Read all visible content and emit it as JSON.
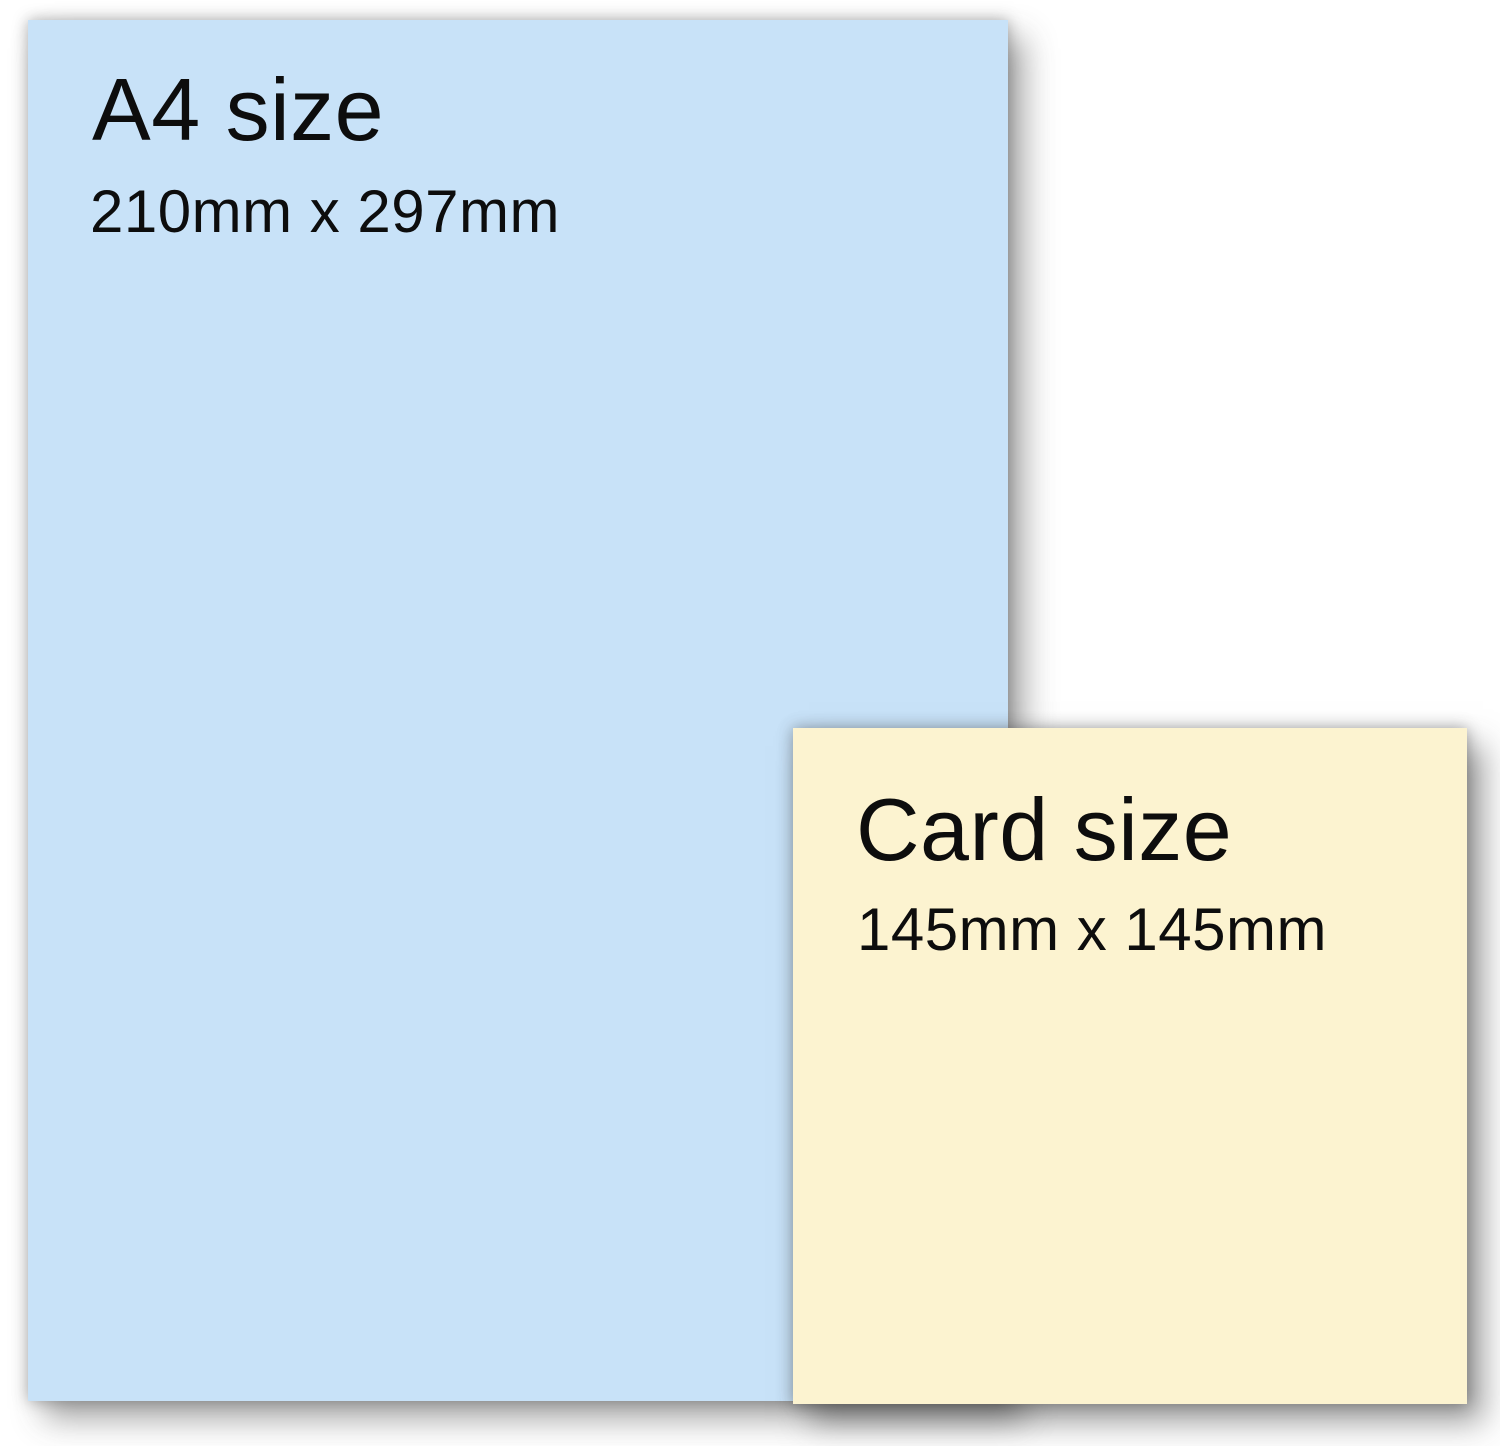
{
  "figure": {
    "background_color": "#ffffff",
    "text_color": "#0d0d0d"
  },
  "a4_sheet": {
    "title": "A4 size",
    "dimensions": "210mm x 297mm",
    "fill_color": "#c8e2f8"
  },
  "card_sheet": {
    "title": "Card size",
    "dimensions": "145mm x 145mm",
    "fill_color": "#fcf3d0"
  }
}
